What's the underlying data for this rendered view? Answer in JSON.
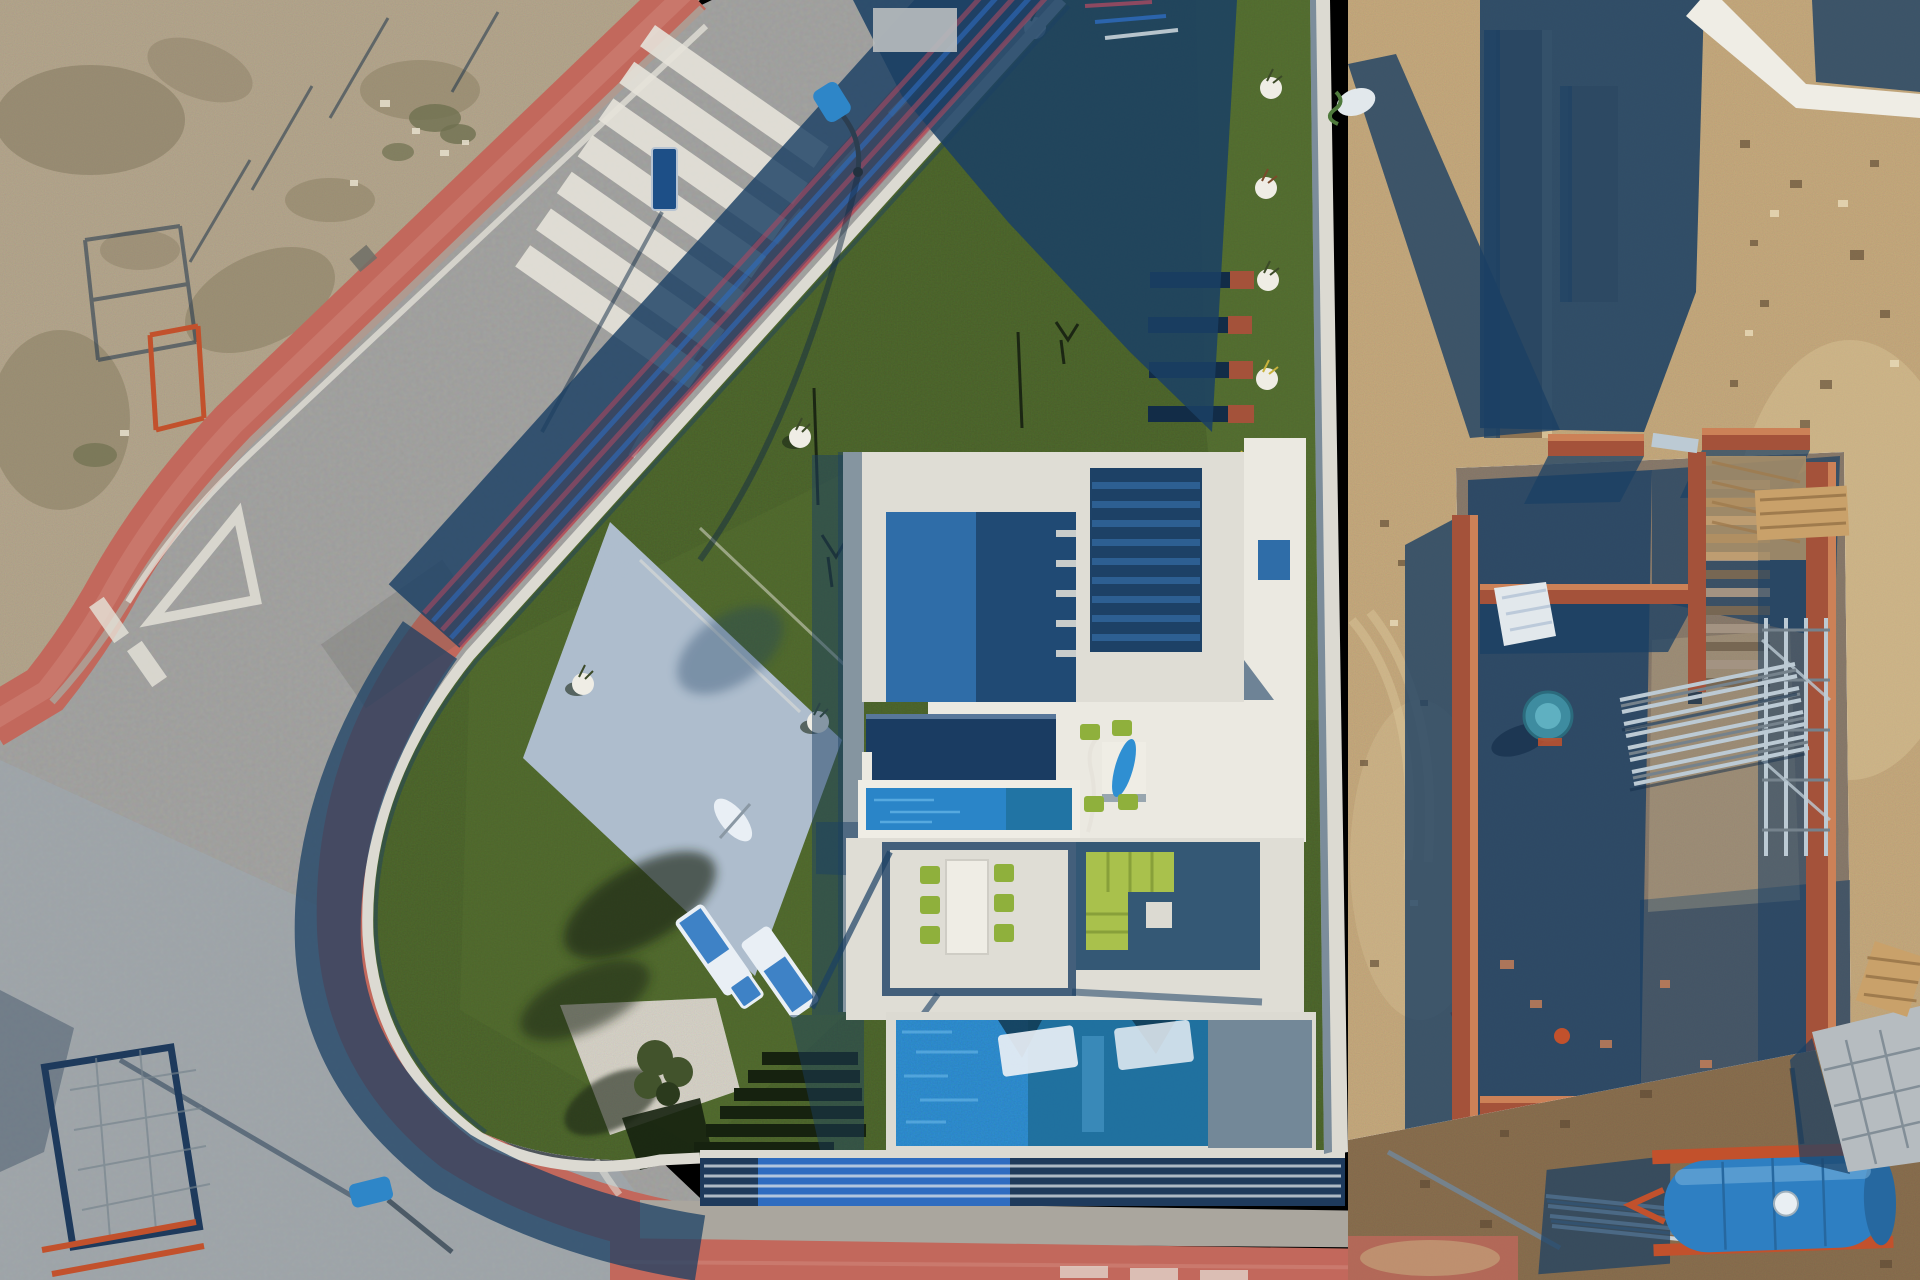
{
  "image": {
    "alt": "Top-down aerial drone photograph: modern white flat-roof villa with artificial lawn, sun loungers, pergola dining set and azure pool on a wedge-shaped corner plot; curved asphalt road with red-tile sidewalks, zebra crossing and yield markings on the left; sandy vacant scrub lot top-left; brick-walled house under construction with scaffolding, cement mixer and a blue water tank trailer on the right; long blue shadows cast toward lower-left."
  },
  "palette": {
    "sand": "#b5a78e",
    "sandDark": "#84795e",
    "sandLight": "#cfc3a9",
    "scrub": "#6f7050",
    "sandRight": "#c6aa7e",
    "sandRightLight": "#dcc79b",
    "dirt": "#8a6f4f",
    "dirtDark": "#5f4b34",
    "road": "#a2a2a0",
    "roadBlue": "#9da9b4",
    "marking": "#e6e3da",
    "sdwkRed": "#c2685c",
    "sdwkRedLight": "#d28a7e",
    "curb": "#aaa69e",
    "shadow": "#1b4064",
    "shadowDeep": "#122c47",
    "grass": "#4f682e",
    "grassLight": "#617d38",
    "grassShadow": "#1a2817",
    "hedge": "#16220f",
    "gravel": "#d7d3c8",
    "tree": "#42532c",
    "treeDark": "#2b3a1d",
    "pad": "#b3c2d6",
    "wall": "#dcdad2",
    "wallBright": "#efede5",
    "wallTop": "#b6bbbd",
    "roof": "#dfddd5",
    "roofBright": "#ebe9e1",
    "roofBlue": "#2f6da8",
    "roofBlueDeep": "#1d4166",
    "stepBlue": "#2d5f92",
    "canopy": "#1a3c62",
    "pool": "#2f8fd2",
    "poolRipple": "#6ab8e8",
    "poolShade": "#1f6f9b",
    "poolTri": "#123a52",
    "spa": "#2a85c8",
    "fenceBlue": "#2e6cc0",
    "fenceNavy": "#1e3a5c",
    "fenceWhite": "#dde4e8",
    "fenceRed": "#a84a62",
    "deck": "#1d4568",
    "chair": "#8fb03c",
    "sofa": "#a9c14c",
    "table": "#efede5",
    "lounger": "#3e82c6",
    "loungerPad": "#e9eff5",
    "brick": "#a4523a",
    "brickLight": "#cc8157",
    "concrete": "#8a7b6c",
    "scaffold": "#bccad4",
    "steel": "#75828c",
    "mixer": "#3e8ca0",
    "mixerLight": "#5fb0c1",
    "tarp": "#e2e8ec",
    "wood": "#c9a16a",
    "woodDark": "#9f7b4d",
    "tank": "#2e7fc2",
    "tankDark": "#2668a0",
    "tankCap": "#e9eff3",
    "trailer": "#c2512c",
    "block": "#b6bcc0",
    "pipe": "#c9d3d9",
    "sign": "#1d4f87",
    "lamp": "#2e86c8",
    "stain": "#c08a7a",
    "skid": "#5d5d58"
  },
  "scene": {
    "left": [
      "vacant scrub lot",
      "red tiled sidewalks",
      "curved asphalt road",
      "zebra crosswalk",
      "yield triangle marking",
      "street sign",
      "street lamps",
      "orange site fence panels"
    ],
    "center": [
      "wedge-shaped villa plot",
      "white boundary wall with blue slat fence",
      "artificial lawn",
      "light parking pad",
      "white planters",
      "raised planter beds",
      "sun loungers",
      "gravel bed with olive tree",
      "hedge steps",
      "white villa roofs",
      "blue shaded courtyard",
      "staircase",
      "navy carport canopy",
      "pergola with long dining table and six green chairs",
      "roof table with parasol and four green chairs",
      "lime corner sofa",
      "spa water strip",
      "azure swimming pool with white in-pool loungers",
      "navy slat pool fence"
    ],
    "right": [
      "sand strip with debris",
      "trenches",
      "white neighbour wall corner",
      "brick walls under construction",
      "concrete slab",
      "interior stairs",
      "cement mixer",
      "reflective tarp",
      "scaffolding and pole stacks",
      "wood pallets",
      "blue water tank on orange trailer",
      "grey block stacks",
      "silver pipes",
      "dug brown soil"
    ]
  }
}
